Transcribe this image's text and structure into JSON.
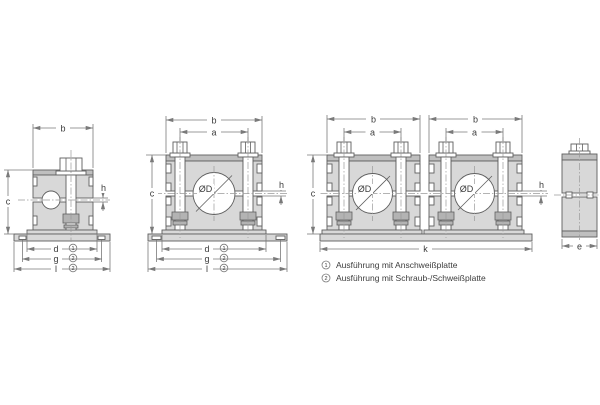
{
  "colors": {
    "background": "#ffffff",
    "body_fill": "#d8d8d8",
    "band_fill": "#bfbfbf",
    "hardware_fill": "#b3b3b3",
    "white_fill": "#ffffff",
    "outline": "#5f5f5f",
    "dim_line": "#7a7a7a",
    "centerline": "#9a9a9a",
    "text": "#3c3c3c"
  },
  "dim_labels": {
    "a": "a",
    "b": "b",
    "c": "c",
    "d": "d",
    "e": "e",
    "g": "g",
    "h": "h",
    "k": "k",
    "l": "l",
    "diameter": "ØD"
  },
  "notes": {
    "n1": "1",
    "n2": "2"
  },
  "legend": {
    "item1": "Ausführung mit Anschweißplatte",
    "item2": "Ausführung mit Schraub-/Schweißplatte"
  }
}
